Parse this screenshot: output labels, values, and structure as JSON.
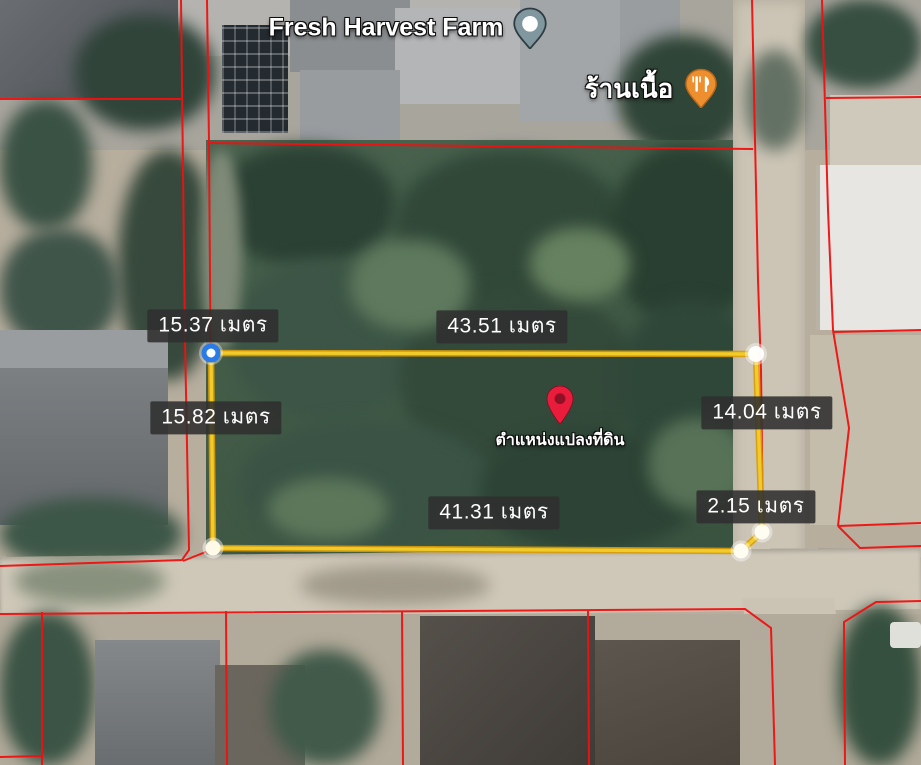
{
  "poi": {
    "fresh_harvest": {
      "label": "Fresh Harvest Farm"
    },
    "butcher": {
      "label": "ร้านเนื้อ"
    }
  },
  "land_pin": {
    "label": "ตำแหน่งแปลงที่ดิน"
  },
  "measurements": [
    {
      "side": "northwest",
      "text": "15.37 เมตร"
    },
    {
      "side": "north",
      "text": "43.51 เมตร"
    },
    {
      "side": "west",
      "text": "15.82 เมตร"
    },
    {
      "side": "east",
      "text": "14.04 เมตร"
    },
    {
      "side": "south",
      "text": "41.31 เมตร"
    },
    {
      "side": "southeast-corner",
      "text": "2.15 เมตร"
    }
  ],
  "colors": {
    "measure_line": "#f0cb2a",
    "measure_line_shadow": "#d99b07",
    "cadastral_line": "#f11010",
    "selected_vertex_ring": "#2a7be8",
    "label_background": "#2f2f2f",
    "land_pin_red": "#ea1c3c",
    "poi_pin_orange": "#ee8f2f",
    "poi_pin_teal": "#8097a0"
  }
}
